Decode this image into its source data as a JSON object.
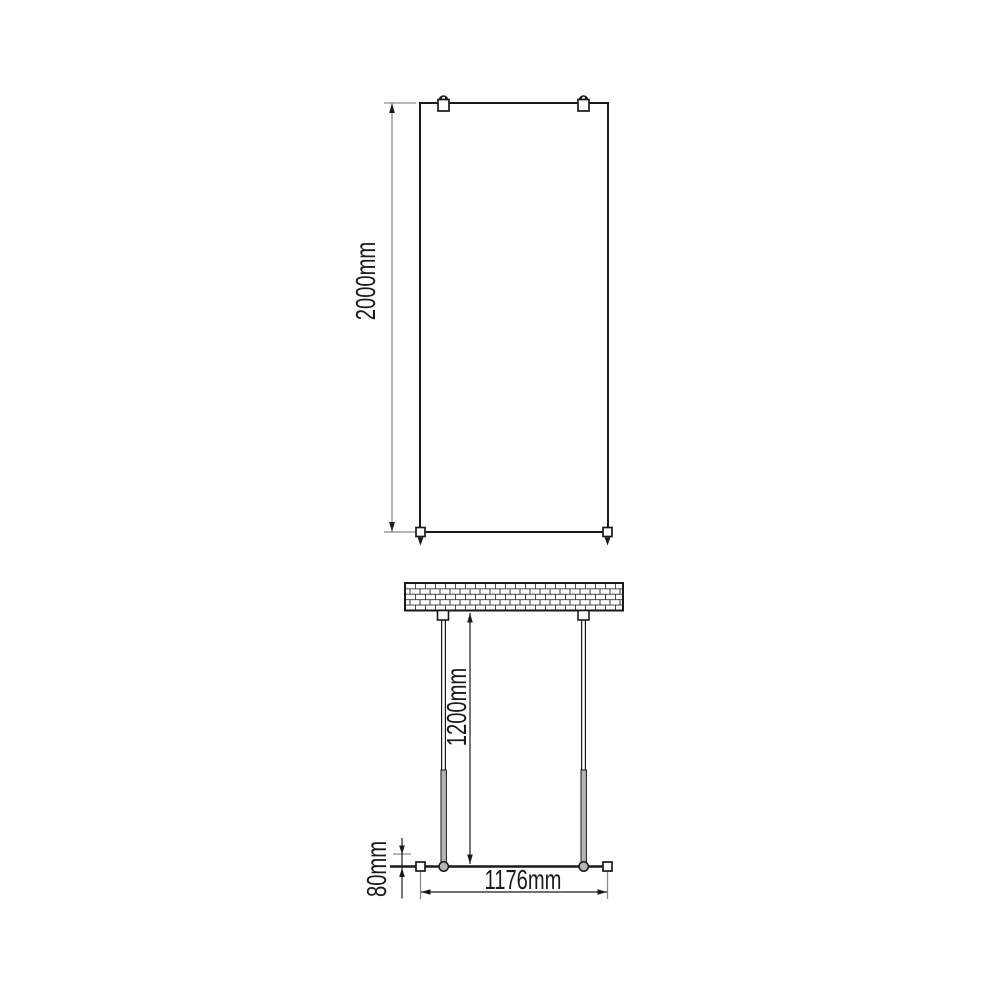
{
  "colors": {
    "line": "#1a1a1a",
    "dim": "#8c8c8c",
    "grayfill": "#b5b5b5"
  },
  "drawing": {
    "front_view": {
      "height": "2000mm"
    },
    "plan_view": {
      "bar_length": "1200mm",
      "glass_width": "1176mm",
      "profile_depth": "80mm"
    }
  }
}
